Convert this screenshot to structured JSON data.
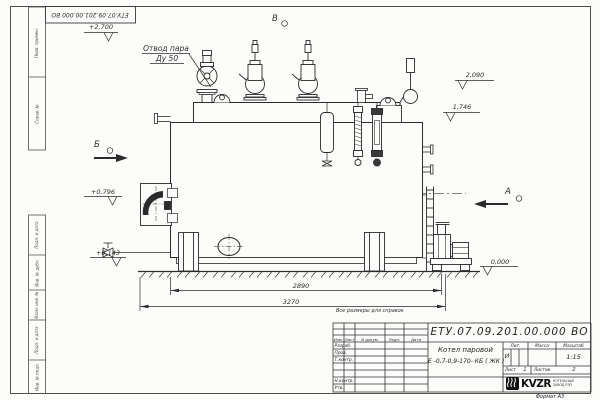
{
  "frame": {
    "top_stamp": "ЕТУ.07.09.201.00.000  ВО",
    "format_note": "Формат А3",
    "margin_top": [
      "Перв. примен.",
      "Справ. №"
    ],
    "margin_bottom": [
      "Подп. и дата",
      "Инв. № дубл.",
      "Взам. инв. №",
      "Подп. и дата",
      "Инв. № подл."
    ]
  },
  "note": "Все размеры для справок",
  "drawing": {
    "steam_label_1": "Отвод пара",
    "steam_label_2": "Ду 50",
    "views": {
      "top": "В",
      "left": "Б",
      "right": "А"
    },
    "elevations": {
      "e2700": "+2,700",
      "e2090": "2,090",
      "e1746": "1,746",
      "e0796": "+0,796",
      "e0143": "+0,143",
      "e0000": "0,000"
    },
    "dimensions": {
      "inner": "2890",
      "overall": "3270"
    }
  },
  "title_block": {
    "doc_number": "ЕТУ.07.09.201.00.000  ВО",
    "name_line1": "Котел паровой",
    "name_line2": "Е -0,7-0,9-170- КБ ( ЖК )",
    "col_izm": "Изм.",
    "col_list": "Лист",
    "col_ndoc": "N докум.",
    "col_podp": "Подп.",
    "col_data": "Дата",
    "row_razrab": "Разраб.",
    "row_prov": "Пров.",
    "row_tkontr": "Т.контр.",
    "row_nkontr": "Н.контр.",
    "row_utv": "Утв.",
    "lit_label": "Лит.",
    "mass_label": "Масса",
    "scale_label": "Масштаб",
    "lit_value": "И",
    "scale_value": "1:15",
    "sheet_label": "Лист",
    "sheet_value": "1",
    "sheets_label": "Листов",
    "sheets_value": "2",
    "logo_text": "KVZR",
    "logo_sub1": "КОТЕЛЬНЫЙ",
    "logo_sub2": "ЗАВОД РЭП"
  }
}
